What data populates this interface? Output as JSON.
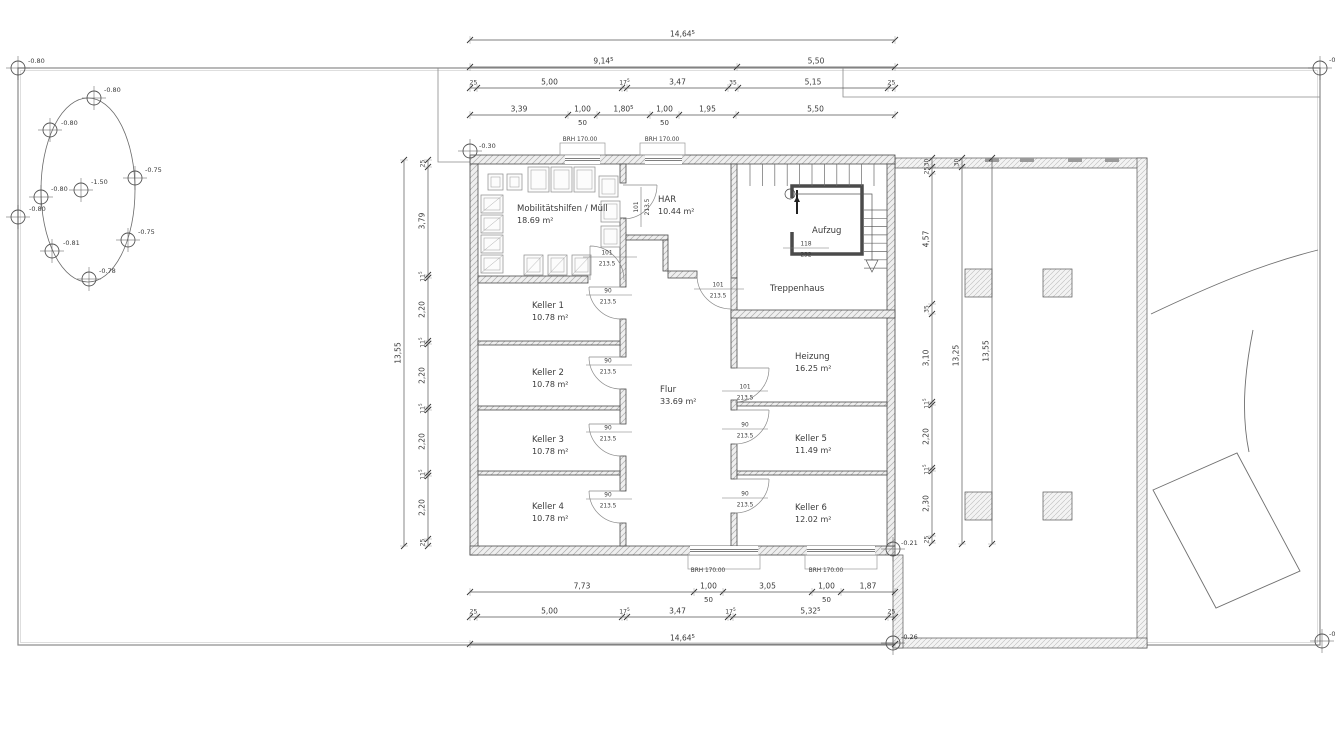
{
  "drawing": {
    "rooms": [
      {
        "id": "mobility",
        "name": "Mobilitätshilfen / Müll",
        "area": "18.69 m²",
        "x": 517,
        "y": 211
      },
      {
        "id": "har",
        "name": "HAR",
        "area": "10.44 m²",
        "x": 658,
        "y": 202
      },
      {
        "id": "aufzug",
        "name": "Aufzug",
        "area": "",
        "x": 812,
        "y": 233
      },
      {
        "id": "treppenhaus",
        "name": "Treppenhaus",
        "area": "",
        "x": 770,
        "y": 291
      },
      {
        "id": "keller1",
        "name": "Keller 1",
        "area": "10.78 m²",
        "x": 532,
        "y": 308
      },
      {
        "id": "keller2",
        "name": "Keller 2",
        "area": "10.78 m²",
        "x": 532,
        "y": 375
      },
      {
        "id": "keller3",
        "name": "Keller 3",
        "area": "10.78 m²",
        "x": 532,
        "y": 442
      },
      {
        "id": "keller4",
        "name": "Keller 4",
        "area": "10.78 m²",
        "x": 532,
        "y": 509
      },
      {
        "id": "flur",
        "name": "Flur",
        "area": "33.69 m²",
        "x": 660,
        "y": 392
      },
      {
        "id": "heizung",
        "name": "Heizung",
        "area": "16.25 m²",
        "x": 795,
        "y": 359
      },
      {
        "id": "keller5",
        "name": "Keller 5",
        "area": "11.49 m²",
        "x": 795,
        "y": 441
      },
      {
        "id": "keller6",
        "name": "Keller 6",
        "area": "12.02 m²",
        "x": 795,
        "y": 510
      }
    ],
    "door_labels": [
      {
        "id": "door-mobility",
        "w": "101",
        "h": "213.5",
        "cx": 607,
        "ly": 257,
        "l1": 583,
        "l2": 637
      },
      {
        "id": "door-har",
        "w": "101",
        "h": "213.5",
        "rot": true,
        "cx": 641,
        "cy": 207
      },
      {
        "id": "door-treppenhaus",
        "w": "101",
        "h": "213.5",
        "cx": 718,
        "ly": 289,
        "l1": 694,
        "l2": 744
      },
      {
        "id": "door-keller1",
        "w": "90",
        "h": "213.5",
        "cx": 608,
        "ly": 295,
        "l1": 586,
        "l2": 632
      },
      {
        "id": "door-keller2",
        "w": "90",
        "h": "213.5",
        "cx": 608,
        "ly": 365,
        "l1": 586,
        "l2": 632
      },
      {
        "id": "door-keller3",
        "w": "90",
        "h": "213.5",
        "cx": 608,
        "ly": 432,
        "l1": 586,
        "l2": 632
      },
      {
        "id": "door-keller4",
        "w": "90",
        "h": "213.5",
        "cx": 608,
        "ly": 499,
        "l1": 586,
        "l2": 632
      },
      {
        "id": "door-heizung",
        "w": "101",
        "h": "213.5",
        "cx": 745,
        "ly": 391,
        "l1": 722,
        "l2": 768
      },
      {
        "id": "door-keller5",
        "w": "90",
        "h": "213.5",
        "cx": 745,
        "ly": 429,
        "l1": 722,
        "l2": 768
      },
      {
        "id": "door-keller6",
        "w": "90",
        "h": "213.5",
        "cx": 745,
        "ly": 498,
        "l1": 722,
        "l2": 768
      },
      {
        "id": "lift-size",
        "w": "118",
        "h": "232",
        "cx": 806,
        "ly": 248,
        "l1": 783,
        "l2": 829
      }
    ],
    "window_labels": [
      {
        "t": "BRH 170.00",
        "x": 580,
        "y": 141
      },
      {
        "t": "BRH 170.00",
        "x": 662,
        "y": 141
      },
      {
        "t": "BRH 170.00",
        "x": 708,
        "y": 572
      },
      {
        "t": "BRH 170.00",
        "x": 826,
        "y": 572
      }
    ],
    "elevation_markers": [
      {
        "v": "-0.80",
        "x": 18,
        "y": 68,
        "lx": 28,
        "ly": 63
      },
      {
        "v": "-0",
        "x": 1320,
        "y": 68,
        "lx": 1329,
        "ly": 62
      },
      {
        "v": "-0.80",
        "x": 18,
        "y": 217,
        "lx": 29,
        "ly": 211
      },
      {
        "v": "-0",
        "x": 1322,
        "y": 641,
        "lx": 1329,
        "ly": 636
      },
      {
        "v": "-0.80",
        "x": 94,
        "y": 98,
        "lx": 104,
        "ly": 92
      },
      {
        "v": "-0.80",
        "x": 50,
        "y": 130,
        "lx": 61,
        "ly": 125
      },
      {
        "v": "-0.75",
        "x": 135,
        "y": 178,
        "lx": 145,
        "ly": 172
      },
      {
        "v": "-1.50",
        "x": 81,
        "y": 190,
        "lx": 91,
        "ly": 184
      },
      {
        "v": "-0.80",
        "x": 41,
        "y": 197,
        "lx": 51,
        "ly": 191
      },
      {
        "v": "-0.81",
        "x": 52,
        "y": 251,
        "lx": 63,
        "ly": 245
      },
      {
        "v": "-0.75",
        "x": 128,
        "y": 240,
        "lx": 138,
        "ly": 234
      },
      {
        "v": "-0.78",
        "x": 89,
        "y": 279,
        "lx": 99,
        "ly": 273
      },
      {
        "v": "-0.30",
        "x": 470,
        "y": 151,
        "lx": 479,
        "ly": 148
      },
      {
        "v": "-0.21",
        "x": 893,
        "y": 549,
        "lx": 901,
        "ly": 545
      },
      {
        "v": "-0.26",
        "x": 893,
        "y": 643,
        "lx": 901,
        "ly": 639
      }
    ],
    "dim_chains": [
      {
        "id": "top-overall",
        "dir": "h",
        "x": 470,
        "y": 40,
        "segs": [
          {
            "l": "14,64^5",
            "len": 425
          }
        ]
      },
      {
        "id": "top-2",
        "dir": "h",
        "x": 470,
        "y": 67,
        "segs": [
          {
            "l": "9,14^5",
            "len": 267
          },
          {
            "l": "5,50",
            "len": 158
          }
        ]
      },
      {
        "id": "top-3",
        "dir": "h",
        "x": 470,
        "y": 88,
        "segs": [
          {
            "l": "25",
            "len": 7,
            "small": true
          },
          {
            "l": "5,00",
            "len": 145
          },
          {
            "l": "17^5",
            "len": 5,
            "small": true
          },
          {
            "l": "3,47",
            "len": 101
          },
          {
            "l": "35",
            "len": 10,
            "small": true
          },
          {
            "l": "5,15",
            "len": 150
          },
          {
            "l": "25",
            "len": 7,
            "small": true
          }
        ]
      },
      {
        "id": "top-4",
        "dir": "h",
        "x": 470,
        "y": 115,
        "segs": [
          {
            "l": "3,39",
            "len": 98
          },
          {
            "l": "1,00",
            "len": 29,
            "sub": "50"
          },
          {
            "l": "1,80^5",
            "len": 53
          },
          {
            "l": "1,00",
            "len": 29,
            "sub": "50"
          },
          {
            "l": "1,95",
            "len": 57
          },
          {
            "l": "5,50",
            "len": 159
          }
        ]
      },
      {
        "id": "bottom-1",
        "dir": "h",
        "x": 470,
        "y": 592,
        "segs": [
          {
            "l": "7,73",
            "len": 224
          },
          {
            "l": "1,00",
            "len": 29,
            "sub": "50"
          },
          {
            "l": "3,05",
            "len": 89
          },
          {
            "l": "1,00",
            "len": 29,
            "sub": "50"
          },
          {
            "l": "1,87",
            "len": 54
          }
        ]
      },
      {
        "id": "bottom-2",
        "dir": "h",
        "x": 470,
        "y": 617,
        "segs": [
          {
            "l": "25",
            "len": 7,
            "small": true
          },
          {
            "l": "5,00",
            "len": 145
          },
          {
            "l": "17^5",
            "len": 5,
            "small": true
          },
          {
            "l": "3,47",
            "len": 101
          },
          {
            "l": "17^5",
            "len": 5,
            "small": true
          },
          {
            "l": "5,32^5",
            "len": 155
          },
          {
            "l": "25",
            "len": 7,
            "small": true
          }
        ]
      },
      {
        "id": "bottom-overall",
        "dir": "h",
        "x": 470,
        "y": 644,
        "segs": [
          {
            "l": "14,64^5",
            "len": 425
          }
        ]
      },
      {
        "id": "left-overall",
        "dir": "v",
        "x": 404,
        "y": 160,
        "segs": [
          {
            "l": "13,55",
            "len": 386
          }
        ]
      },
      {
        "id": "left-chain",
        "dir": "v",
        "x": 428,
        "y": 160,
        "segs": [
          {
            "l": "25",
            "len": 7,
            "small": true
          },
          {
            "l": "3,79",
            "len": 108
          },
          {
            "l": "11^5",
            "len": 3,
            "small": true
          },
          {
            "l": "2,20",
            "len": 63
          },
          {
            "l": "11^5",
            "len": 3,
            "small": true
          },
          {
            "l": "2,20",
            "len": 63
          },
          {
            "l": "11^5",
            "len": 3,
            "small": true
          },
          {
            "l": "2,20",
            "len": 63
          },
          {
            "l": "11^5",
            "len": 3,
            "small": true
          },
          {
            "l": "2,20",
            "len": 63
          },
          {
            "l": "25",
            "len": 7,
            "small": true
          }
        ]
      },
      {
        "id": "right-chain",
        "dir": "v",
        "x": 932,
        "y": 158,
        "segs": [
          {
            "l": "30",
            "len": 9,
            "small": true
          },
          {
            "l": "25",
            "len": 7,
            "small": true
          },
          {
            "l": "4,57",
            "len": 130
          },
          {
            "l": "35",
            "len": 10,
            "small": true
          },
          {
            "l": "3,10",
            "len": 88
          },
          {
            "l": "11^5",
            "len": 3,
            "small": true
          },
          {
            "l": "2,20",
            "len": 63
          },
          {
            "l": "11^5",
            "len": 3,
            "small": true
          },
          {
            "l": "2,30",
            "len": 65
          },
          {
            "l": "25",
            "len": 7,
            "small": true
          }
        ]
      },
      {
        "id": "right-2",
        "dir": "v",
        "x": 962,
        "y": 158,
        "segs": [
          {
            "l": "30",
            "len": 9,
            "small": true
          },
          {
            "l": "13,25",
            "len": 377
          }
        ]
      },
      {
        "id": "right-overall",
        "dir": "v",
        "x": 992,
        "y": 158,
        "segs": [
          {
            "l": "13,55",
            "len": 386
          }
        ]
      }
    ]
  }
}
